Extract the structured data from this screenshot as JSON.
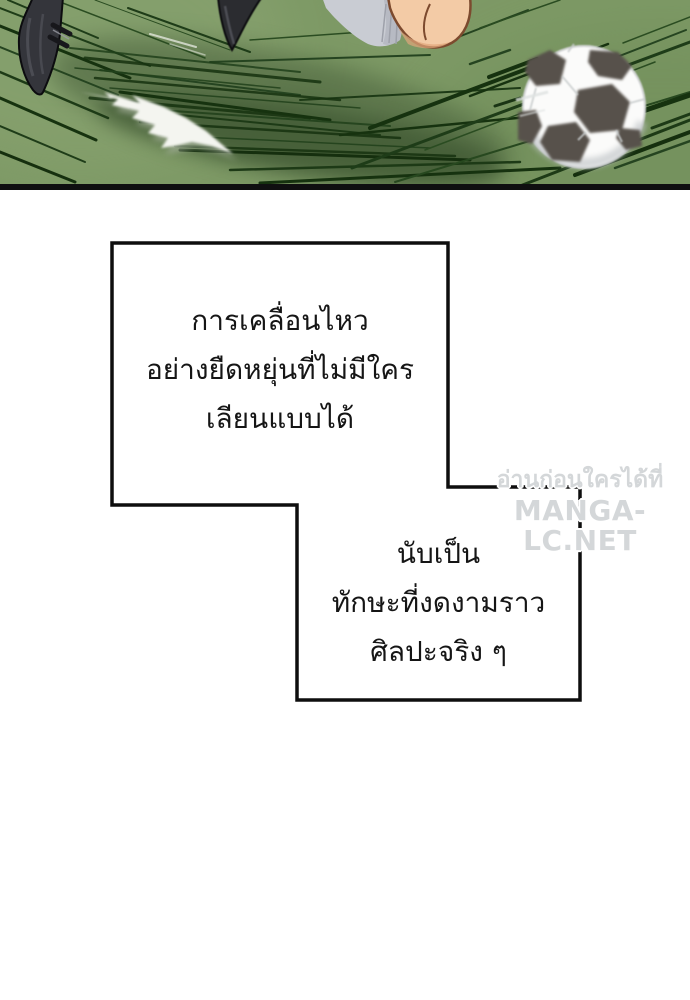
{
  "page": {
    "width": 690,
    "height": 1000,
    "background": "#ffffff"
  },
  "scene": {
    "type": "manga-panel-soccer-kick",
    "colors": {
      "grass": "#7d9965",
      "grass_light": "#8ca573",
      "grass_dark": "#6f8c58",
      "motion_streak": "#1e3c18",
      "player_shadow": "#3f5634",
      "field_border": "#0f0f10",
      "ball_white": "#fbfbfa",
      "ball_patch": "#57514b",
      "shoe": "#34353b",
      "sock": "#c9ccd3",
      "skin": "#f3cba6"
    }
  },
  "captions": {
    "box1": {
      "lines": [
        "การเคลื่อนไหว",
        "อย่างยืดหยุ่นที่ไม่มีใคร",
        "เลียนแบบได้"
      ]
    },
    "box2": {
      "lines": [
        "นับเป็น",
        "ทักษะที่งดงามราว",
        "ศิลปะจริง ๆ"
      ]
    }
  },
  "watermark": {
    "line1": "อ่านก่อนใครได้ที่",
    "line2": "MANGA-LC.NET",
    "color": "#d4d7d9"
  }
}
